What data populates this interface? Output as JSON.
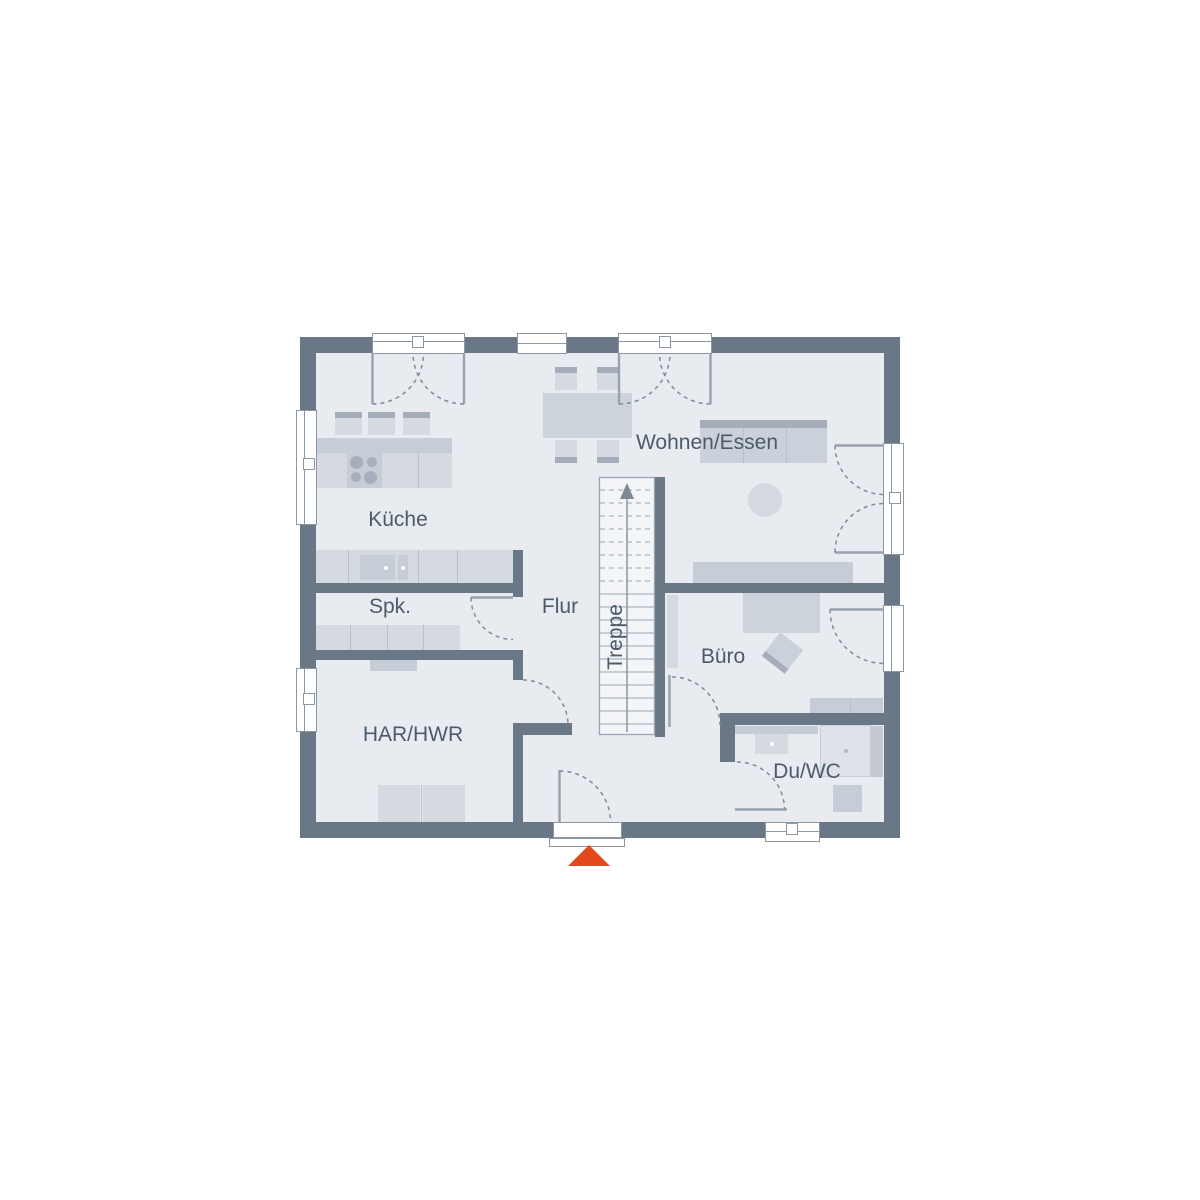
{
  "plan_title": "Erdgeschoss Grundriss",
  "rooms": {
    "kueche": {
      "label": "Küche"
    },
    "spk": {
      "label": "Spk."
    },
    "har_hwr": {
      "label": "HAR/HWR"
    },
    "flur": {
      "label": "Flur"
    },
    "treppe": {
      "label": "Treppe"
    },
    "wohnen_essen": {
      "label": "Wohnen/Essen"
    },
    "buero": {
      "label": "Büro"
    },
    "du_wc": {
      "label": "Du/WC"
    }
  },
  "markers": {
    "entrance": {
      "icon": "triangle-up",
      "color": "#E2491D"
    },
    "stairs_direction": {
      "icon": "arrow-up",
      "direction": "up"
    }
  },
  "colors": {
    "wall": "#6A7787",
    "floor": "#E8EBF0",
    "furniture_light": "#D5DAE1",
    "furniture_mid": "#C7CDD6",
    "furniture_dark": "#A4ADB9",
    "line": "#8C97A4",
    "stairs_fill": "#F3F5F8",
    "text": "#4C5B6B",
    "entrance_accent": "#E2491D"
  }
}
